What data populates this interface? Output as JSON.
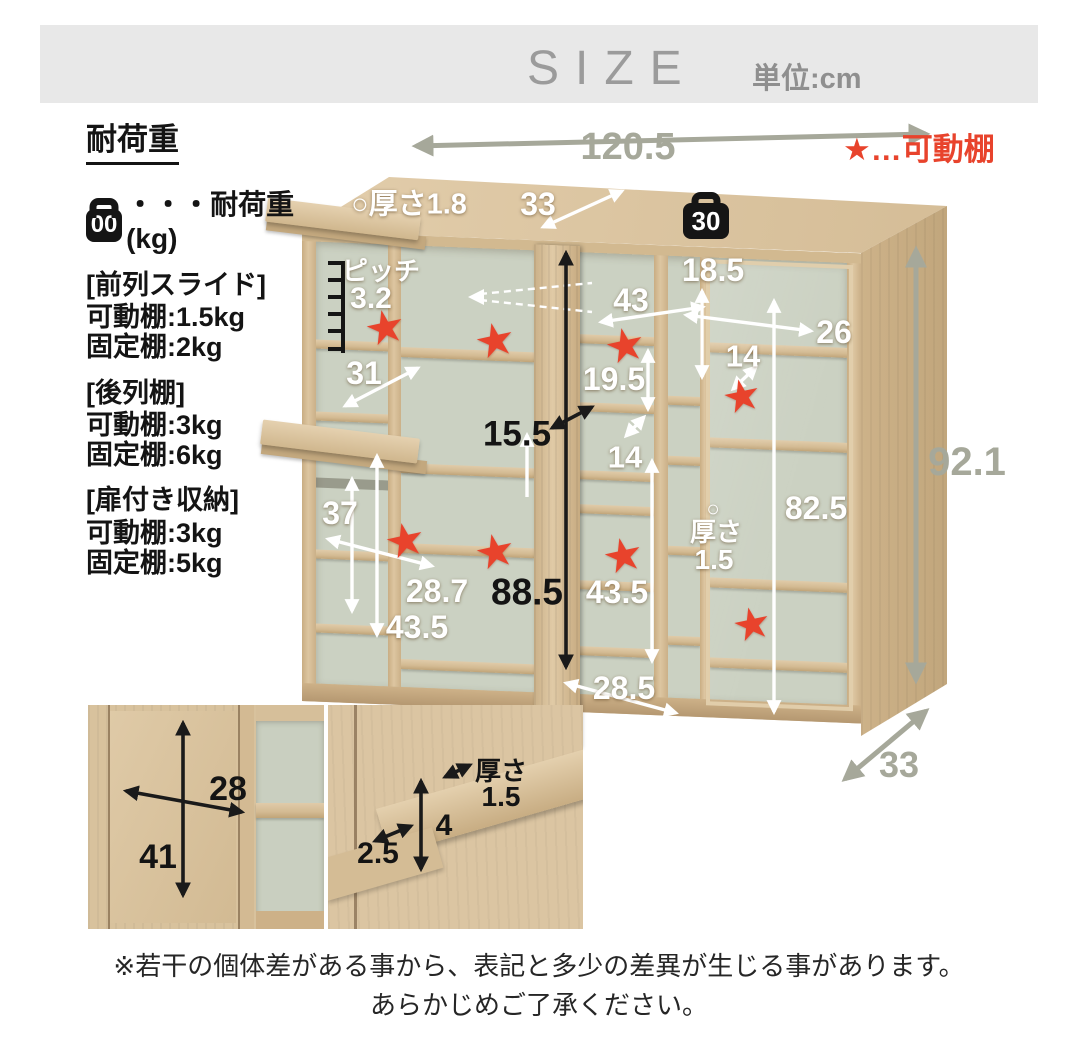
{
  "header": {
    "title": "SIZE",
    "unit": "単位:cm"
  },
  "load": {
    "heading": "耐荷重",
    "icon_text": "00",
    "icon_desc": "・・・耐荷重(kg)",
    "groups": [
      {
        "name": "[前列スライド]",
        "line1": "可動棚:1.5kg",
        "line2": "固定棚:2kg"
      },
      {
        "name": "[後列棚]",
        "line1": "可動棚:3kg",
        "line2": "固定棚:6kg"
      },
      {
        "name": "[扉付き収納]",
        "line1": "可動棚:3kg",
        "line2": "固定棚:5kg"
      }
    ]
  },
  "legend": {
    "movable_star": "★…可動棚"
  },
  "symbols": {
    "star": "★"
  },
  "diagram": {
    "weight_badge": "30",
    "dims": {
      "width": "120.5",
      "height": "92.1",
      "depth": "33",
      "top_thickness": "○厚さ1.8",
      "top_depth": "33",
      "right_top_h": "18.5",
      "right_w": "26",
      "right_gap": "14",
      "mid_w": "43",
      "mid_cell": "19.5",
      "mid_gap": "14",
      "pitch_label": "ピッチ",
      "pitch_value": "3.2",
      "left_cell": "31",
      "slide_clear": "15.5",
      "left_low": "37",
      "slide_depth": "28.7",
      "left_h": "43.5",
      "back_h": "88.5",
      "mid_h": "43.5",
      "slide_w": "28.5",
      "right_h": "82.5",
      "circle": "○",
      "thick_label": "厚さ",
      "thick_value": "1.5"
    }
  },
  "insets": {
    "door_w": "28",
    "door_h": "41",
    "thick_label": "厚さ",
    "thick_value": "1.5",
    "lip_h": "4",
    "lip_d": "2.5"
  },
  "disclaimer": {
    "line1": "※若干の個体差がある事から、表記と多少の差異が生じる事があります。",
    "line2": "あらかじめご了承ください。"
  },
  "colors": {
    "accent_red": "#e8432c",
    "dim_gray": "#a6a89a",
    "wood": "#d6bf9a",
    "back_panel": "#cbd1c2",
    "header_bg": "#e8e8e8",
    "header_text": "#9b9b9b"
  }
}
